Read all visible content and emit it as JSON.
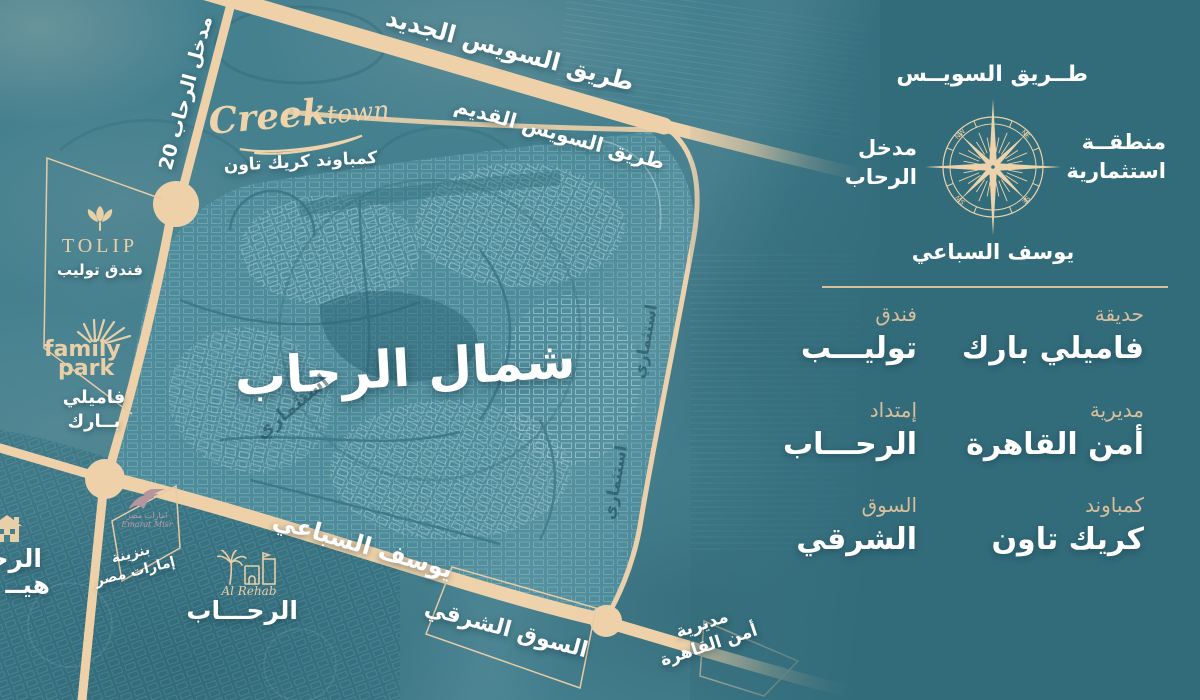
{
  "title": {
    "region": "شمال الرحاب"
  },
  "roads": {
    "new_suez": "طريق السويس الجديد",
    "old_suez": "طريق السويس القديم",
    "entrance_20": "مدخل الرحاب 20",
    "yousef_sebai": "يوسف السباعي"
  },
  "areas": {
    "investment": "استثماري",
    "eastern_market": "السوق الشرقي",
    "security_line1": "مديرية",
    "security_line2": "أمن القاهرة",
    "gas_line1": "بنزينة",
    "gas_line2": "إمارات مصر",
    "edge_line1": "الرحـ",
    "edge_line2": "هيــ",
    "alrehab": "الرحـــاب"
  },
  "logos": {
    "creek_script_1": "Creek",
    "creek_script_2": "town",
    "creek_ar": "كمباوند كريك تاون",
    "tolip_en": "TOLIP",
    "tolip_ar": "فندق توليب",
    "family_en_1": "family",
    "family_en_2": "park",
    "family_ar_1": "فاميلي",
    "family_ar_2": "بــارك",
    "rehab_script": "Al Rehab",
    "emarat_ar": "امارات مصر",
    "emarat_en": "Emarat Misr"
  },
  "compass": {
    "north": "طــريق السويــس",
    "east_1": "منطقــة",
    "east_2": "استثمارية",
    "west_1": "مدخل",
    "west_2": "الرحاب",
    "south": "يوسف السباعي",
    "nw": "NW",
    "ne": "NE",
    "se": "SE",
    "sw": "SW"
  },
  "legend": {
    "items": [
      {
        "category": "حديقة",
        "name": "فاميلي بارك"
      },
      {
        "category": "فندق",
        "name": "توليـــب"
      },
      {
        "category": "مديرية",
        "name": "أمن القاهرة"
      },
      {
        "category": "إمتداد",
        "name": "الرحـــاب"
      },
      {
        "category": "كمباوند",
        "name": "كريك تاون"
      },
      {
        "category": "السوق",
        "name": "الشرقي"
      }
    ]
  },
  "colors": {
    "background": "#326b7a",
    "map_base": "#45808f",
    "road": "#eed1a9",
    "accent_beige": "#d9bf9c",
    "compass_beige": "#ecd3ac",
    "white": "#ffffff"
  }
}
